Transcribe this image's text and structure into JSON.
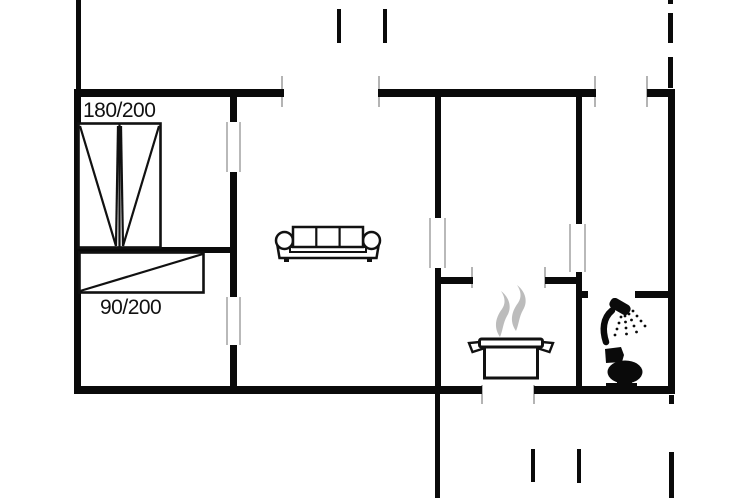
{
  "floorplan": {
    "beds": {
      "double": {
        "label": "180/200"
      },
      "single": {
        "label": "90/200"
      }
    },
    "colors": {
      "wall": "#0a0a0a",
      "background": "#ffffff",
      "opening_marker_gray": "#b4b4b4",
      "steam_gray": "#bcbcbc"
    },
    "icons": {
      "double_bed": "double-bed-icon",
      "single_bed": "single-bed-icon",
      "sofa": "sofa-icon",
      "cooking_pot": "cooking-pot-steam-icon",
      "shower": "shower-head-icon",
      "toilet": "toilet-icon"
    }
  }
}
